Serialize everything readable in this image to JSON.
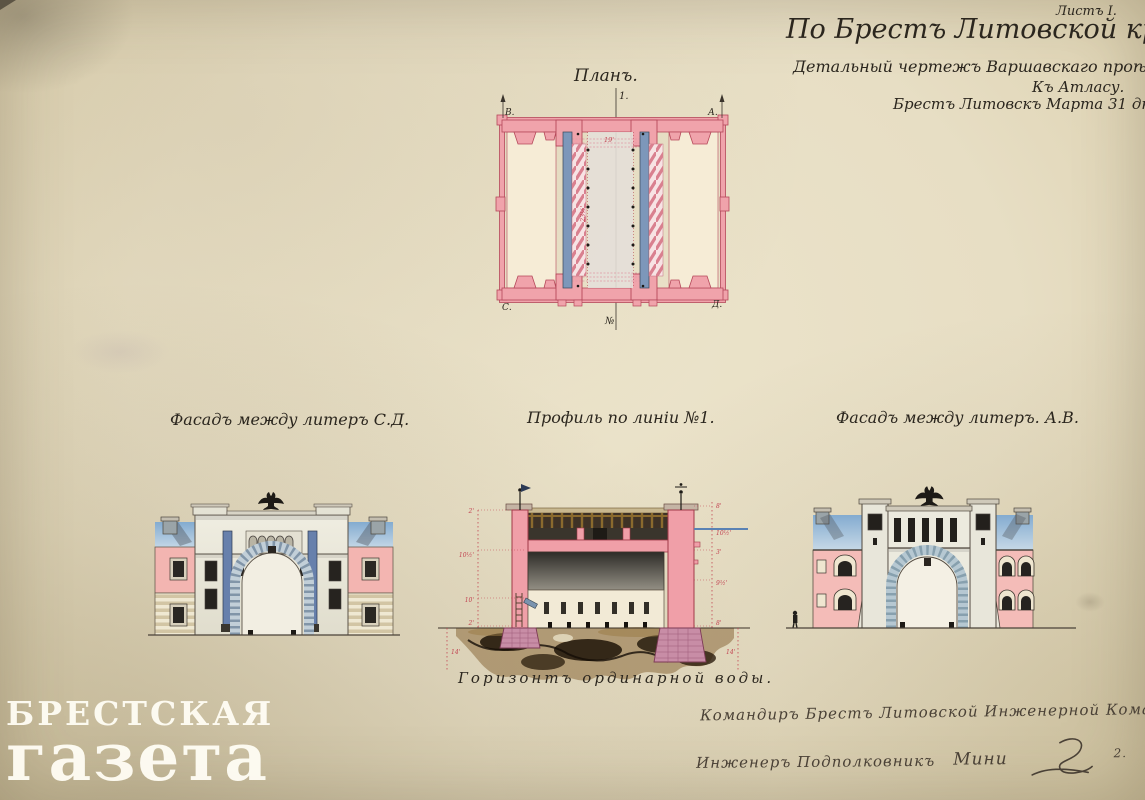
{
  "palette": {
    "paper": "#e8dfc4",
    "ink": "#2b261e",
    "masonry_pink": "#f0a0aa",
    "outline_red": "#b5485a",
    "timber_blue": "#7d97ba",
    "sky_blue": "#8fb4d6",
    "earth_brown": "#3a2a16",
    "dimension_red": "#c24452",
    "watermark_white": "#fdfaf0"
  },
  "title_block": {
    "sheet_label": "Листъ I.",
    "title": "По Брестъ Литовской крѣпости.",
    "subtitle": "Детальный чертежъ Варшавскаго проѣзда.",
    "atlas_note": "Къ Атласу.",
    "date_line": "Брестъ Литовскъ Марта 31 дня 1861 года."
  },
  "plan": {
    "title": "Планъ.",
    "section_mark_top": "1.",
    "section_mark_bottom": "№",
    "corners": {
      "top_left": "В.",
      "top_right": "А.",
      "bottom_left": "С.",
      "bottom_right": "Д."
    },
    "dims": {
      "width": "19'",
      "length": "23½'"
    }
  },
  "views": {
    "left_facade_title": "Фасадъ между литеръ С.Д.",
    "profile_title": "Профиль по линіи №1.",
    "right_facade_title": "Фасадъ между литеръ. А.В."
  },
  "profile": {
    "water_level_label": "Горизонтъ ординарной воды.",
    "left_dims": [
      "2'",
      "10½'",
      "10'",
      "2'",
      "14'"
    ],
    "right_dims": [
      "8'",
      "10½'",
      "3'",
      "9½'",
      "8'",
      "14'"
    ]
  },
  "signature": {
    "line1": "Командиръ Брестъ Литовской Инженерной Команды",
    "line2": "Инженеръ Подполковникъ",
    "name": "Мини",
    "suffix": "2."
  },
  "watermark": {
    "line1": "БРЕСТСКАЯ",
    "line2": "газета"
  }
}
